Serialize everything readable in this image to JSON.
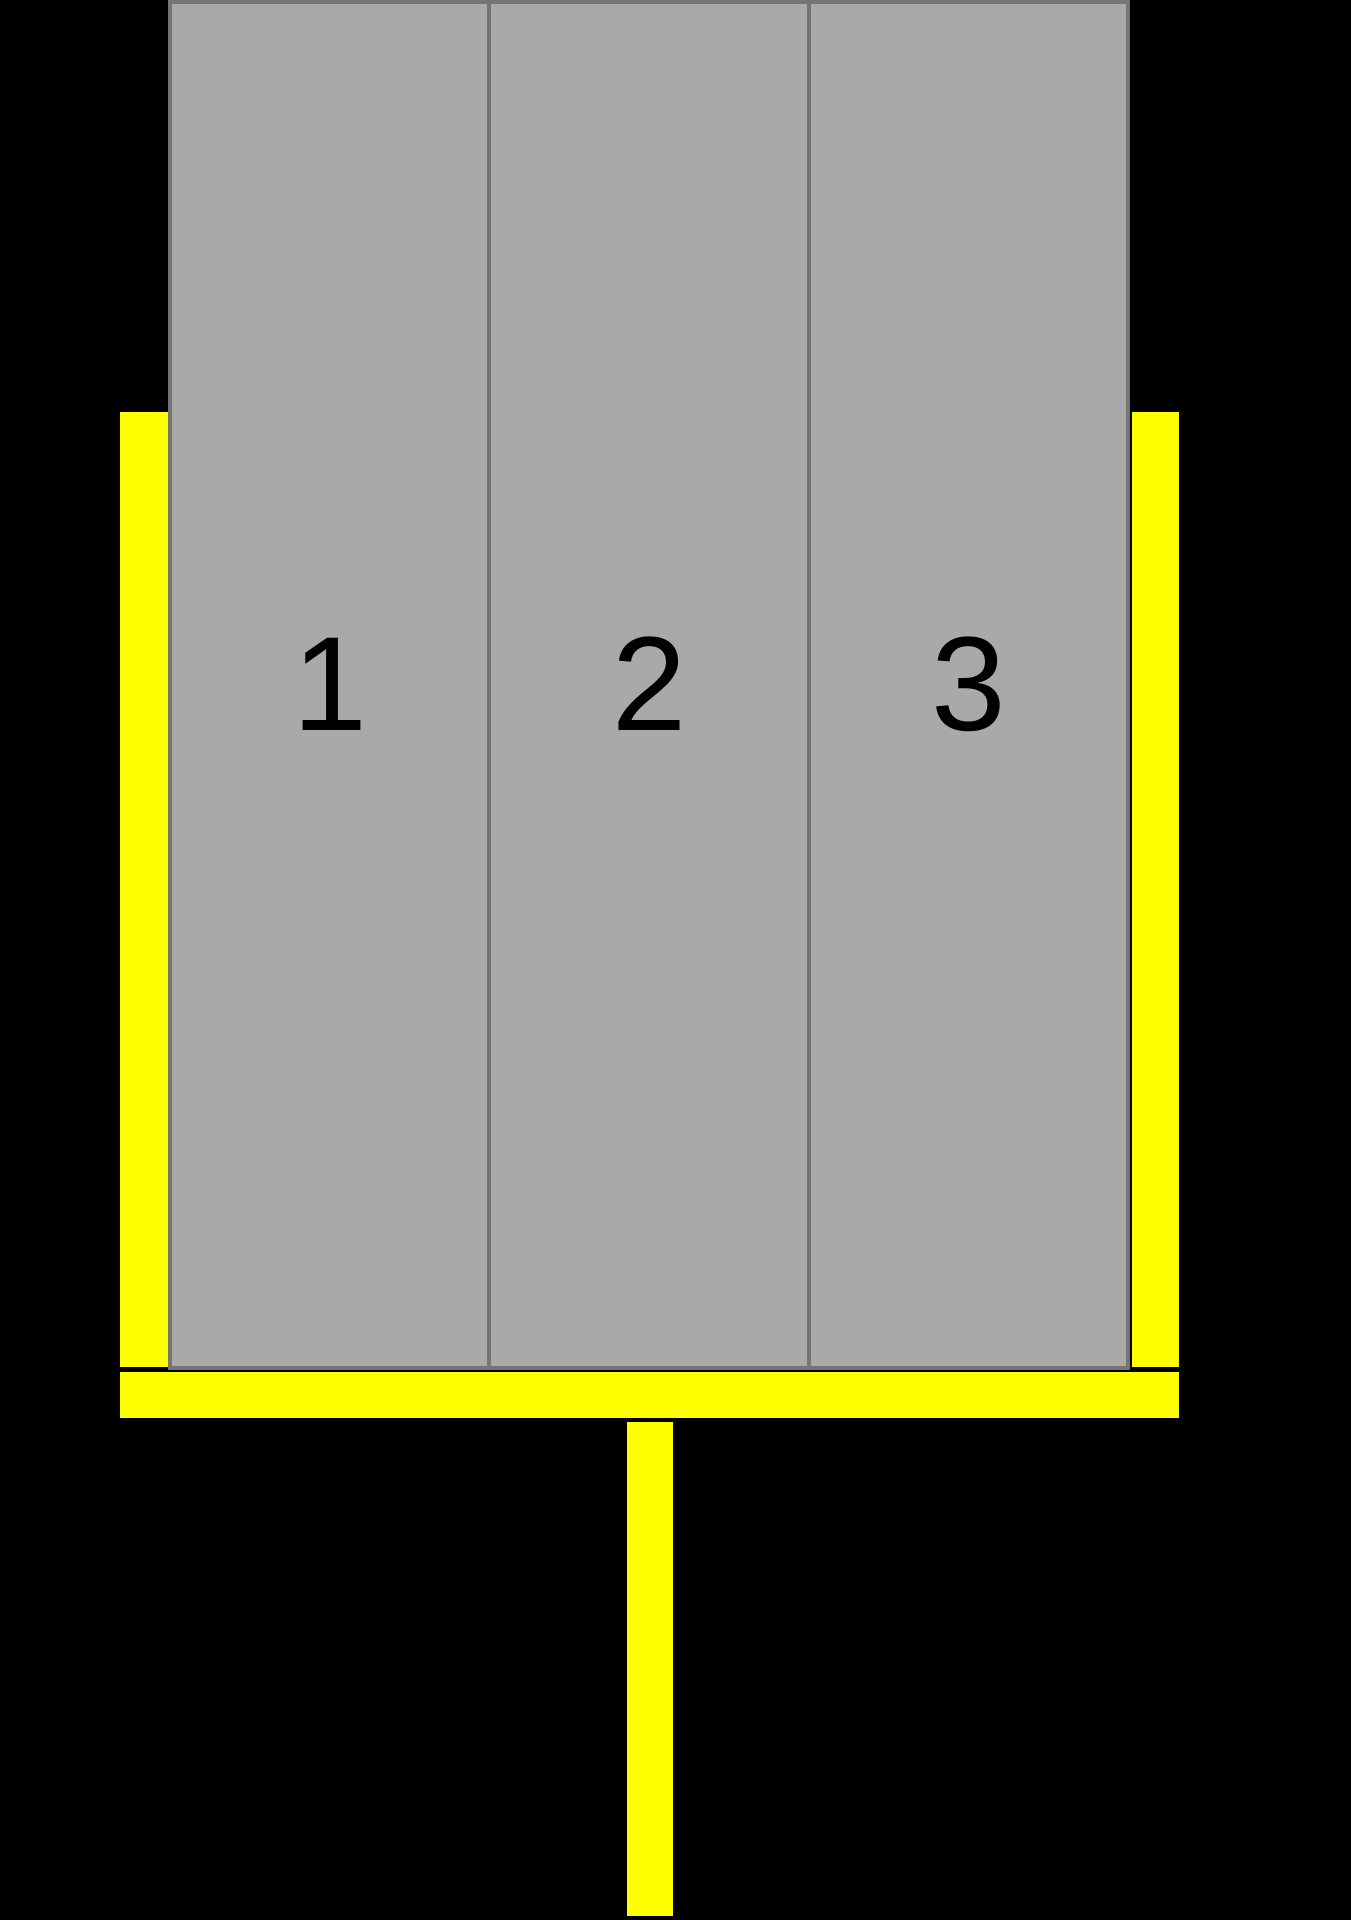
{
  "diagram": {
    "slabs": [
      {
        "label": "1"
      },
      {
        "label": "2"
      },
      {
        "label": "3"
      }
    ],
    "colors": {
      "background": "#000000",
      "slab-fill": "#a9a9a9",
      "slab-border": "#757575",
      "label": "#000000",
      "holder": "#ffff00"
    }
  }
}
